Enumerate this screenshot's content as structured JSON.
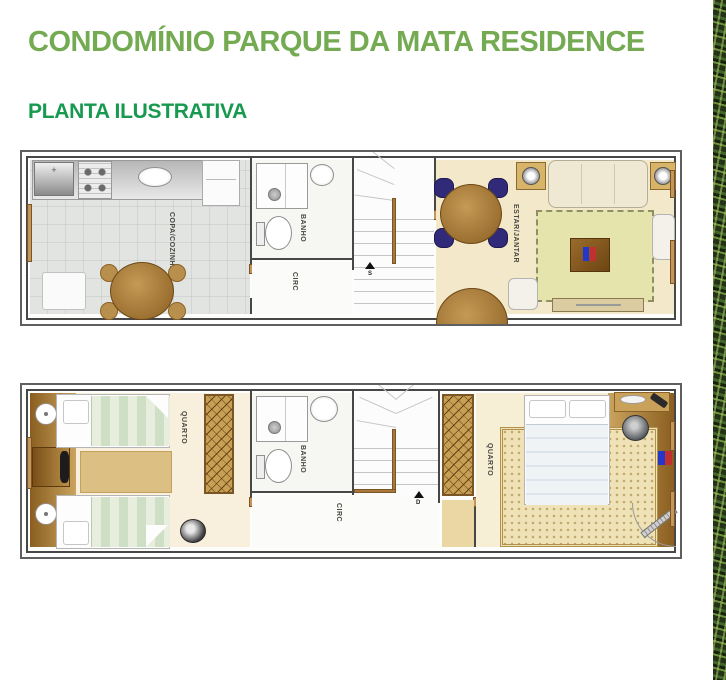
{
  "header": {
    "title": "CONDOMÍNIO PARQUE DA MATA RESIDENCE",
    "subtitle": "PLANTA ILUSTRATIVA"
  },
  "floor1": {
    "kitchen_label": "COPA/COZINHA",
    "bath_label": "BANHO",
    "circ_label": "CIRC",
    "living_label": "ESTAR/JANTAR",
    "stair_arrow": "S"
  },
  "floor2": {
    "bedroom1_label": "QUARTO",
    "bath_label": "BANHO",
    "circ_label": "CIRC",
    "bedroom2_label": "QUARTO",
    "stair_arrow": "D"
  },
  "colors": {
    "title_green": "#74aa51",
    "subtitle_green": "#17994f",
    "wall_gray": "#474747",
    "floor_beige": "#f4e8cb",
    "wood_brown": "#a9782f",
    "chair_blue": "#312a78",
    "rug_green": "#e4e4ac"
  }
}
